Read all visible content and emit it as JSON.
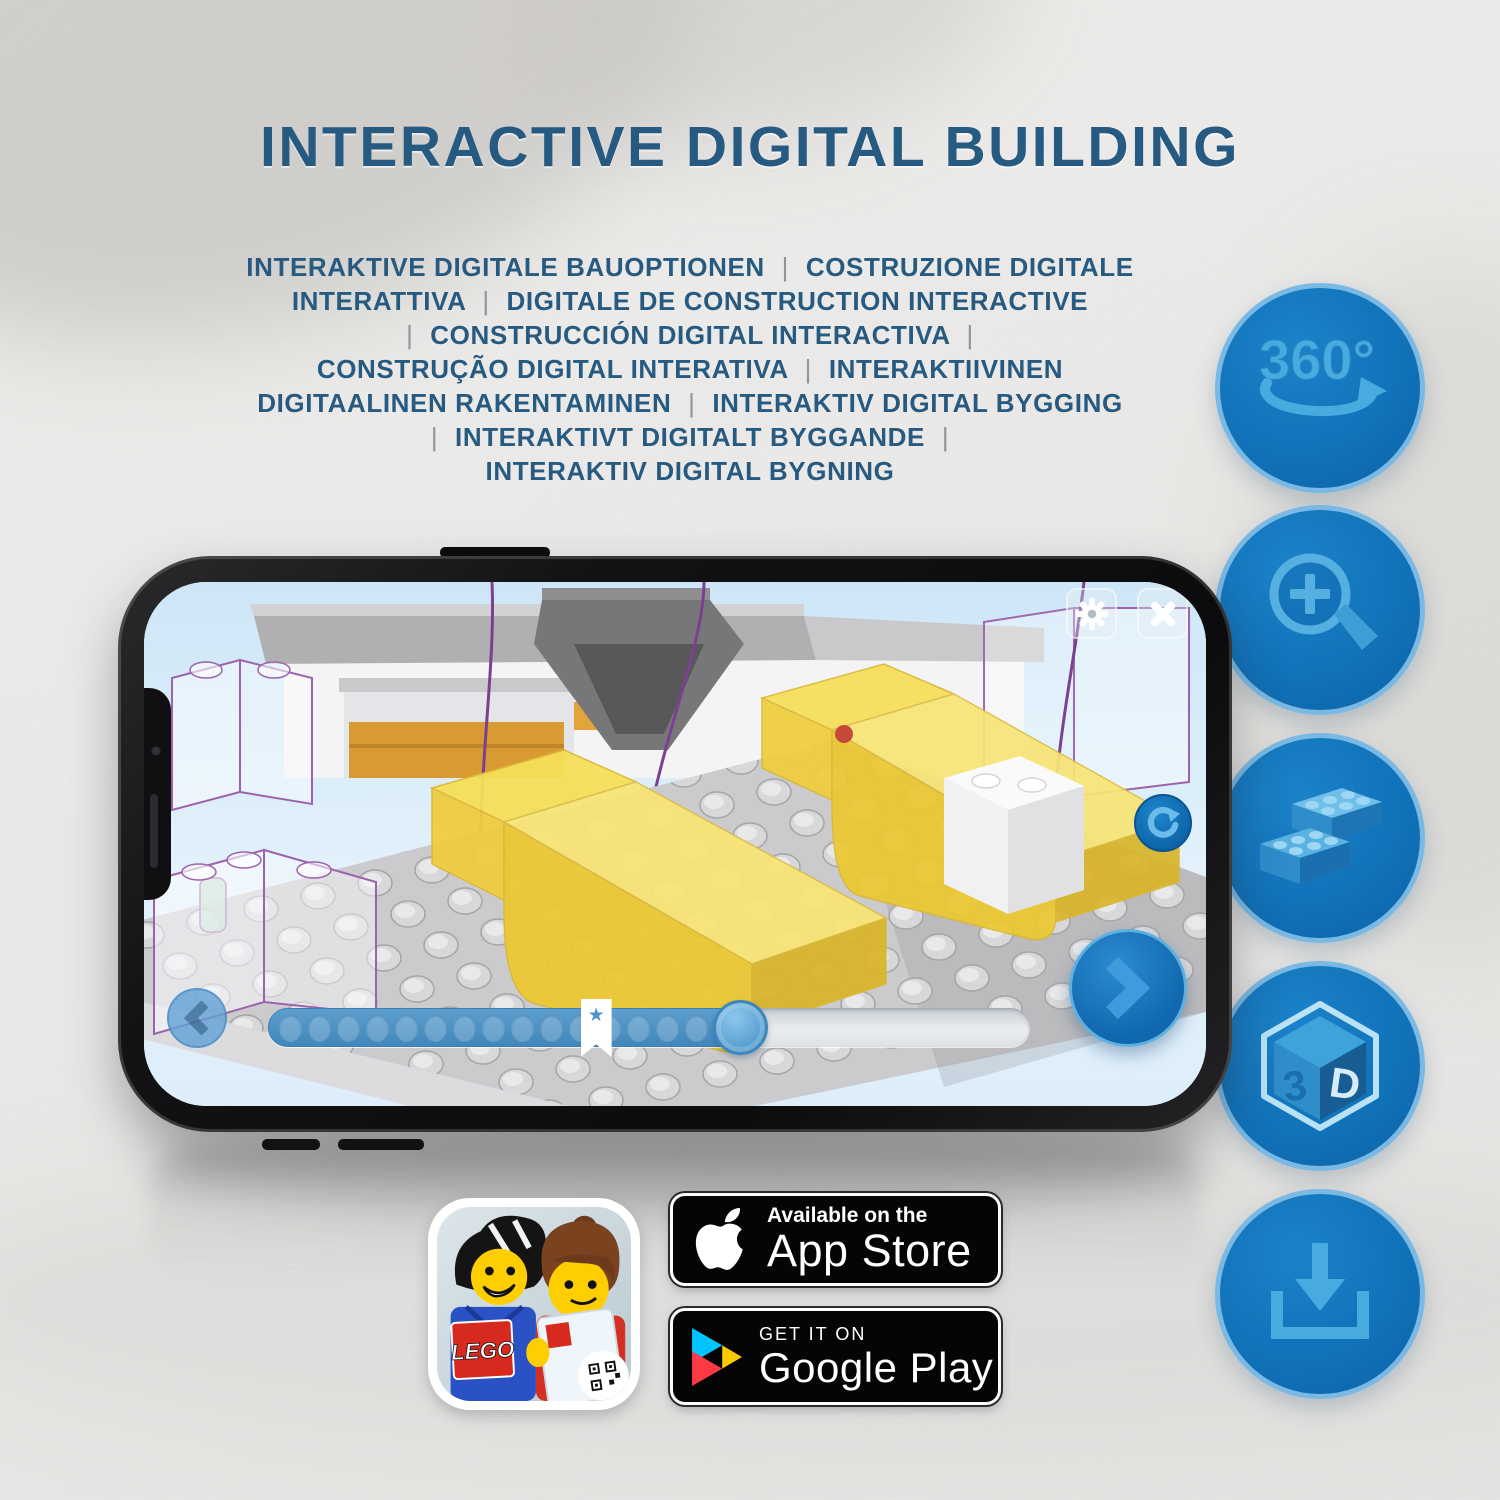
{
  "title": {
    "text": "INTERACTIVE DIGITAL BUILDING",
    "color": "#275a80"
  },
  "subtitle": {
    "separator": "|",
    "lines": [
      [
        "INTERAKTIVE DIGITALE BAUOPTIONEN",
        "|",
        "COSTRUZIONE DIGITALE"
      ],
      [
        "INTERATTIVA",
        "|",
        "DIGITALE DE CONSTRUCTION INTERACTIVE"
      ],
      [
        "|",
        "CONSTRUCCIÓN DIGITAL INTERACTIVA",
        "|"
      ],
      [
        "CONSTRUÇÃO DIGITAL INTERATIVA",
        "|",
        "INTERAKTIIVINEN"
      ],
      [
        "DIGITAALINEN RAKENTAMINEN",
        "|",
        "INTERAKTIV DIGITAL BYGGING"
      ],
      [
        "|",
        "INTERAKTIVT DIGITALT BYGGANDE",
        "|"
      ],
      [
        "INTERAKTIV DIGITAL BYGNING"
      ]
    ]
  },
  "features": {
    "circle_fill": "#1173ba",
    "circle_border": "#79b9e3",
    "icon_color": "#47abe0",
    "items": [
      {
        "id": "rotate-360",
        "label": "360°"
      },
      {
        "id": "zoom-in"
      },
      {
        "id": "bricks"
      },
      {
        "id": "3d-view",
        "face_left": "3",
        "face_right": "D"
      },
      {
        "id": "download"
      }
    ]
  },
  "phone": {
    "app": {
      "toolbar": {
        "buttons": [
          "settings",
          "close"
        ]
      },
      "slider": {
        "dot_count": 16,
        "fill_percent": 64.5,
        "bookmark_percent": 43,
        "handle_percent": 62,
        "bookmark_star": "★"
      },
      "nav": {
        "prev": "chevron-left",
        "next": "chevron-right",
        "rotate": "rotate-clockwise"
      }
    }
  },
  "badges": {
    "app_store": {
      "line1": "Available on the",
      "line2": "App Store"
    },
    "google_play": {
      "line1": "GET IT ON",
      "line2": "Google Play"
    },
    "lego_app": {
      "logo_text": "LEGO"
    }
  }
}
